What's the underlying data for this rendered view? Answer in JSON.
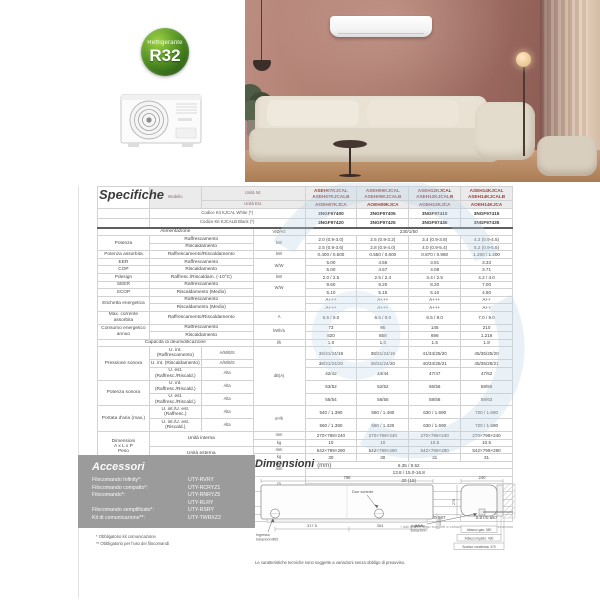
{
  "badge": {
    "line1": "Refrigerante",
    "line2": "R32"
  },
  "spec": {
    "title": "Specifiche",
    "footnote_left": "* Telecomando e WIFI inclusi",
    "footnote_right": "I dati tecnici sono soggetti a variazioni senza obbligo di preavviso",
    "header": {
      "modello": "Modello",
      "unita_int": "Unità Int.",
      "unita_est": "Unità Est.",
      "models_int": [
        [
          "ASEH07KJCAL",
          "ASEH07KJCALB"
        ],
        [
          "ASEH09KJCAL",
          "ASEH09KJCALB"
        ],
        [
          "ASEH12KJCAL",
          "ASEH12KJCALB"
        ],
        [
          "ASEH14KJCAL",
          "ASEH14KJCALB"
        ]
      ],
      "models_est": [
        "AOEH07KJCA",
        "AOEH09KJCA",
        "AOEH12KJCA",
        "AOEH14KJCA"
      ],
      "codice_white_label": "Codice Kit KJCAL White (*)",
      "codice_white": [
        "3NGF97400",
        "3NGF97405",
        "3NGF97410",
        "3NGF97415"
      ],
      "codice_black_label": "Codice Kit KJCALB Black (*)",
      "codice_black": [
        "3NGF97420",
        "3NGF97425",
        "3NGF97430",
        "3NGF97435"
      ]
    },
    "rows": [
      {
        "wl": "Alimentazione",
        "u": "V/Ø/Hz",
        "vs": "230/1/50",
        "cls": "sep-top"
      },
      {
        "l": "Potenza",
        "ls": 2,
        "s": "Raffrescamento",
        "u": "kW",
        "us": 2,
        "v": [
          "2.0 (0.9-3.0)",
          "2.5 (0.9-3.2)",
          "3.4 (0.9-3.8)",
          "4.2 (0.9-4.5)"
        ]
      },
      {
        "s": "Riscaldamento",
        "v": [
          "2.5 (0.9-3.6)",
          "2.8 (0.9-4.0)",
          "4.0 (0.9-5.4)",
          "5.2 (0.9-5.5)"
        ]
      },
      {
        "l": "Potenza assorbita",
        "s": "Raffrescamento/Riscaldamento",
        "u": "kW",
        "v": [
          "0.400 / 0.500",
          "0.550 / 0.600",
          "0.870 / 0.980",
          "1.260 / 1.400"
        ]
      },
      {
        "l": "EER",
        "s": "Raffrescamento",
        "u": "W/W",
        "us": 2,
        "v": [
          "5.00",
          "4.55",
          "3.91",
          "3.33"
        ]
      },
      {
        "l": "COP",
        "s": "Riscaldamento",
        "v": [
          "5.00",
          "4.67",
          "4.08",
          "3.71"
        ]
      },
      {
        "l": "Pdesign",
        "s": "Raffresc./Riscaldam. (-10°C)",
        "u": "kW",
        "v": [
          "2.0 / 2.5",
          "2.5 / 2.4",
          "3.4 / 2.5",
          "4.2 / 4.0"
        ]
      },
      {
        "l": "SEER",
        "s": "Raffrescamento",
        "u": "W/W",
        "us": 2,
        "v": [
          "9.60",
          "9.20",
          "8.20",
          "7.00"
        ]
      },
      {
        "l": "SCOP",
        "s": "Riscaldamento (Medio)",
        "v": [
          "5.10",
          "5.15",
          "5.10",
          "4.60"
        ]
      },
      {
        "l": "Etichetta energetica",
        "ls": 2,
        "s": "Raffrescamento",
        "u": "",
        "us": 2,
        "v": [
          "A+++",
          "A+++",
          "A+++",
          "A++"
        ]
      },
      {
        "s": "Riscaldamento (Medio)",
        "v": [
          "A+++",
          "A+++",
          "A+++",
          "A++"
        ]
      },
      {
        "l": "Max. corrente assorbita",
        "s": "Raffrescamento/Riscaldamento",
        "u": "A",
        "v": [
          "6.5 / 9.0",
          "6.5 / 9.0",
          "6.5 / 9.0",
          "7.0 / 9.0"
        ]
      },
      {
        "l": "Consumo energetico annuo",
        "ls": 2,
        "s": "Raffrescamento",
        "u": "kWh/a",
        "us": 2,
        "v": [
          "73",
          "95",
          "145",
          "210"
        ]
      },
      {
        "s": "Riscaldamento",
        "v": [
          "820",
          "858",
          "698",
          "1.216"
        ]
      },
      {
        "wl": "Capacità di deumidificazione",
        "u": "l/h",
        "v": [
          "1.0",
          "1.0",
          "1.5",
          "1.8"
        ]
      },
      {
        "l": "Pressione sonora",
        "ls": 3,
        "s": "U. int. (Raffrescamento)",
        "g": "A/M/B/S",
        "u": "dB(A)",
        "us": 5,
        "v": [
          "36/31/24/19",
          "38/31/24/19",
          "41/34/25/20",
          "45/35/25/20"
        ]
      },
      {
        "s": "U. int. (Riscaldamento)",
        "g": "A/M/B/S",
        "v": [
          "38/31/24/20",
          "38/31/24/20",
          "40/34/25/21",
          "45/35/25/21"
        ]
      },
      {
        "s": "U. est. (Raffresc./Riscald.)",
        "g": "Alta",
        "v": [
          "42/42",
          "44/44",
          "47/47",
          "47/52"
        ]
      },
      {
        "l": "Potenza sonora",
        "ls": 2,
        "s": "U. int. (Raffresc./Riscald.)",
        "g": "Alta",
        "v": [
          "53/52",
          "52/52",
          "56/56",
          "59/59"
        ]
      },
      {
        "s": "U. est. (Raffresc./Riscald.)",
        "g": "Alta",
        "v": [
          "55/54",
          "56/55",
          "58/58",
          "59/63"
        ]
      },
      {
        "l": "Portata d'aria (max.)",
        "ls": 2,
        "s": "U. int./U. est. (Raffresc.)",
        "g": "Alta",
        "u": "m³/h",
        "us": 2,
        "v": [
          "540 / 1.390",
          "560 / 1.480",
          "630 / 1.690",
          "720 / 1.690"
        ]
      },
      {
        "s": "U. int./U. est. (Riscald.)",
        "g": "Alta",
        "v": [
          "560 / 1.390",
          "560 / 1.420",
          "630 / 1.690",
          "720 / 1.690"
        ]
      },
      {
        "l": "Dimensioni\nA x L x P\nPeso",
        "ls": 4,
        "s": "Unità interna",
        "ss": 2,
        "u": "mm",
        "v": [
          "270×798×240",
          "270×798×240",
          "270×798×240",
          "270×798×240"
        ]
      },
      {
        "u": "kg",
        "v": [
          "10",
          "10",
          "10.5",
          "10.5"
        ]
      },
      {
        "s": "Unità esterna",
        "ss": 2,
        "u": "mm",
        "v": [
          "542×799×290",
          "542×799×290",
          "542×799×290",
          "542×799×290"
        ]
      },
      {
        "u": "kg",
        "v": [
          "30",
          "30",
          "31",
          "31"
        ]
      },
      {
        "wl": "Attacchi tubazioni (liquido/gas)",
        "u": "mm",
        "us": 2,
        "vs": "6.35 / 9.52"
      },
      {
        "wl": "Diametro scarico condensa (int./est.)",
        "vs": "13.8 / 15.0-16.8"
      },
      {
        "wl": "Massima lunghezza tubazioni (Precarica)",
        "u": "m",
        "us": 2,
        "vs": "20 (15)"
      },
      {
        "wl": "Massimo dislivello",
        "vs": "15"
      },
      {
        "l": "Campo di funzionamento",
        "ls": 2,
        "s": "Raffrescamento",
        "u": "°CDB",
        "us": 2,
        "vs": "-10 a 50"
      },
      {
        "s": "Riscaldamento",
        "vs": "-20 a 24"
      },
      {
        "l": "Refrigerante",
        "ls": 2,
        "s": "Tipo/GWP",
        "u": "",
        "vs": "R32 (675)"
      },
      {
        "s": "Carica/TCO₂Eq",
        "u": "kg/TCO₂Eq",
        "v": [
          "0.72/0.486",
          "0.72/0.486",
          "0.87/0.587",
          "0.87/0.587"
        ]
      }
    ]
  },
  "accessories": {
    "title": "Accessori",
    "items": [
      {
        "label": "Filocomando Infinity*:",
        "value": "UTY-RVRY"
      },
      {
        "label": "Filocomando compatto*:",
        "value": "UTY-RCRYZ1"
      },
      {
        "label": "Filocomando*:",
        "value": "UTY-RNRYZ5"
      },
      {
        "label": "",
        "value": "UTY-RLRY"
      },
      {
        "label": "Filocomando semplificato*:",
        "value": "UTY-RSRY"
      },
      {
        "label": "Kit di comunicazione**:",
        "value": "UTY-TWRXZ2"
      }
    ],
    "footnotes": [
      "* Obbligatorio kit comunicazione",
      "** Obbligatorio per l'uso dei filocomandi"
    ]
  },
  "dimensions": {
    "title": "Dimensioni",
    "unit": "(mm)",
    "front": {
      "width": "798",
      "seg1": "317.5",
      "seg2": "354",
      "seg3": "63.5",
      "height_small": "43.5",
      "due_schede": "Due schede",
      "ingresso_1": "Ingresso",
      "ingresso_2": "tubazioni Ø65"
    },
    "side": {
      "depth": "240",
      "height": "270",
      "ingresso_1": "Ingresso",
      "ingresso_2": "tubazioni",
      "gas": "Attacco gas: 380",
      "liquido": "Attacco liquido: 430",
      "condensa": "Scarico condensa: 470"
    },
    "footnote": "Le caratteristiche tecniche sono soggette a variazioni senza obbligo di preavviso."
  },
  "colors": {
    "accent_red": "#a8423a",
    "badge_green": "#2f6414",
    "panel_gray": "#9b9b9b",
    "watermark_blue": "#bcd6e8"
  }
}
